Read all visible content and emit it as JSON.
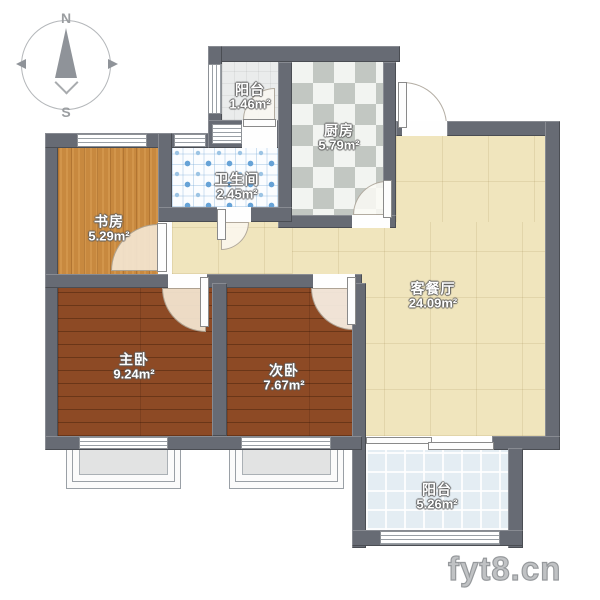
{
  "title": "apartment-floor-plan",
  "compass": {
    "north": "N",
    "south": "S"
  },
  "watermark": "fyt8.cn",
  "rooms": [
    {
      "id": "balcony-top",
      "name": "阳台",
      "area": "1.46m²"
    },
    {
      "id": "kitchen",
      "name": "厨房",
      "area": "5.79m²"
    },
    {
      "id": "bathroom",
      "name": "卫生间",
      "area": "2.45m²"
    },
    {
      "id": "study",
      "name": "书房",
      "area": "5.29m²"
    },
    {
      "id": "living-dining",
      "name": "客餐厅",
      "area": "24.09m²"
    },
    {
      "id": "master-bedroom",
      "name": "主卧",
      "area": "9.24m²"
    },
    {
      "id": "second-bedroom",
      "name": "次卧",
      "area": "7.67m²"
    },
    {
      "id": "balcony-bottom",
      "name": "阳台",
      "area": "5.26m²"
    }
  ],
  "colors": {
    "wall": "#676b74",
    "study_wood": "#c8893f",
    "bedroom_wood": "#8d4a25",
    "living_tile": "#f0e5bd",
    "bathroom_dot": "#67a3d7",
    "balcony_tile": "#e4edf3",
    "kitchen_check": "#c2c7c2"
  }
}
